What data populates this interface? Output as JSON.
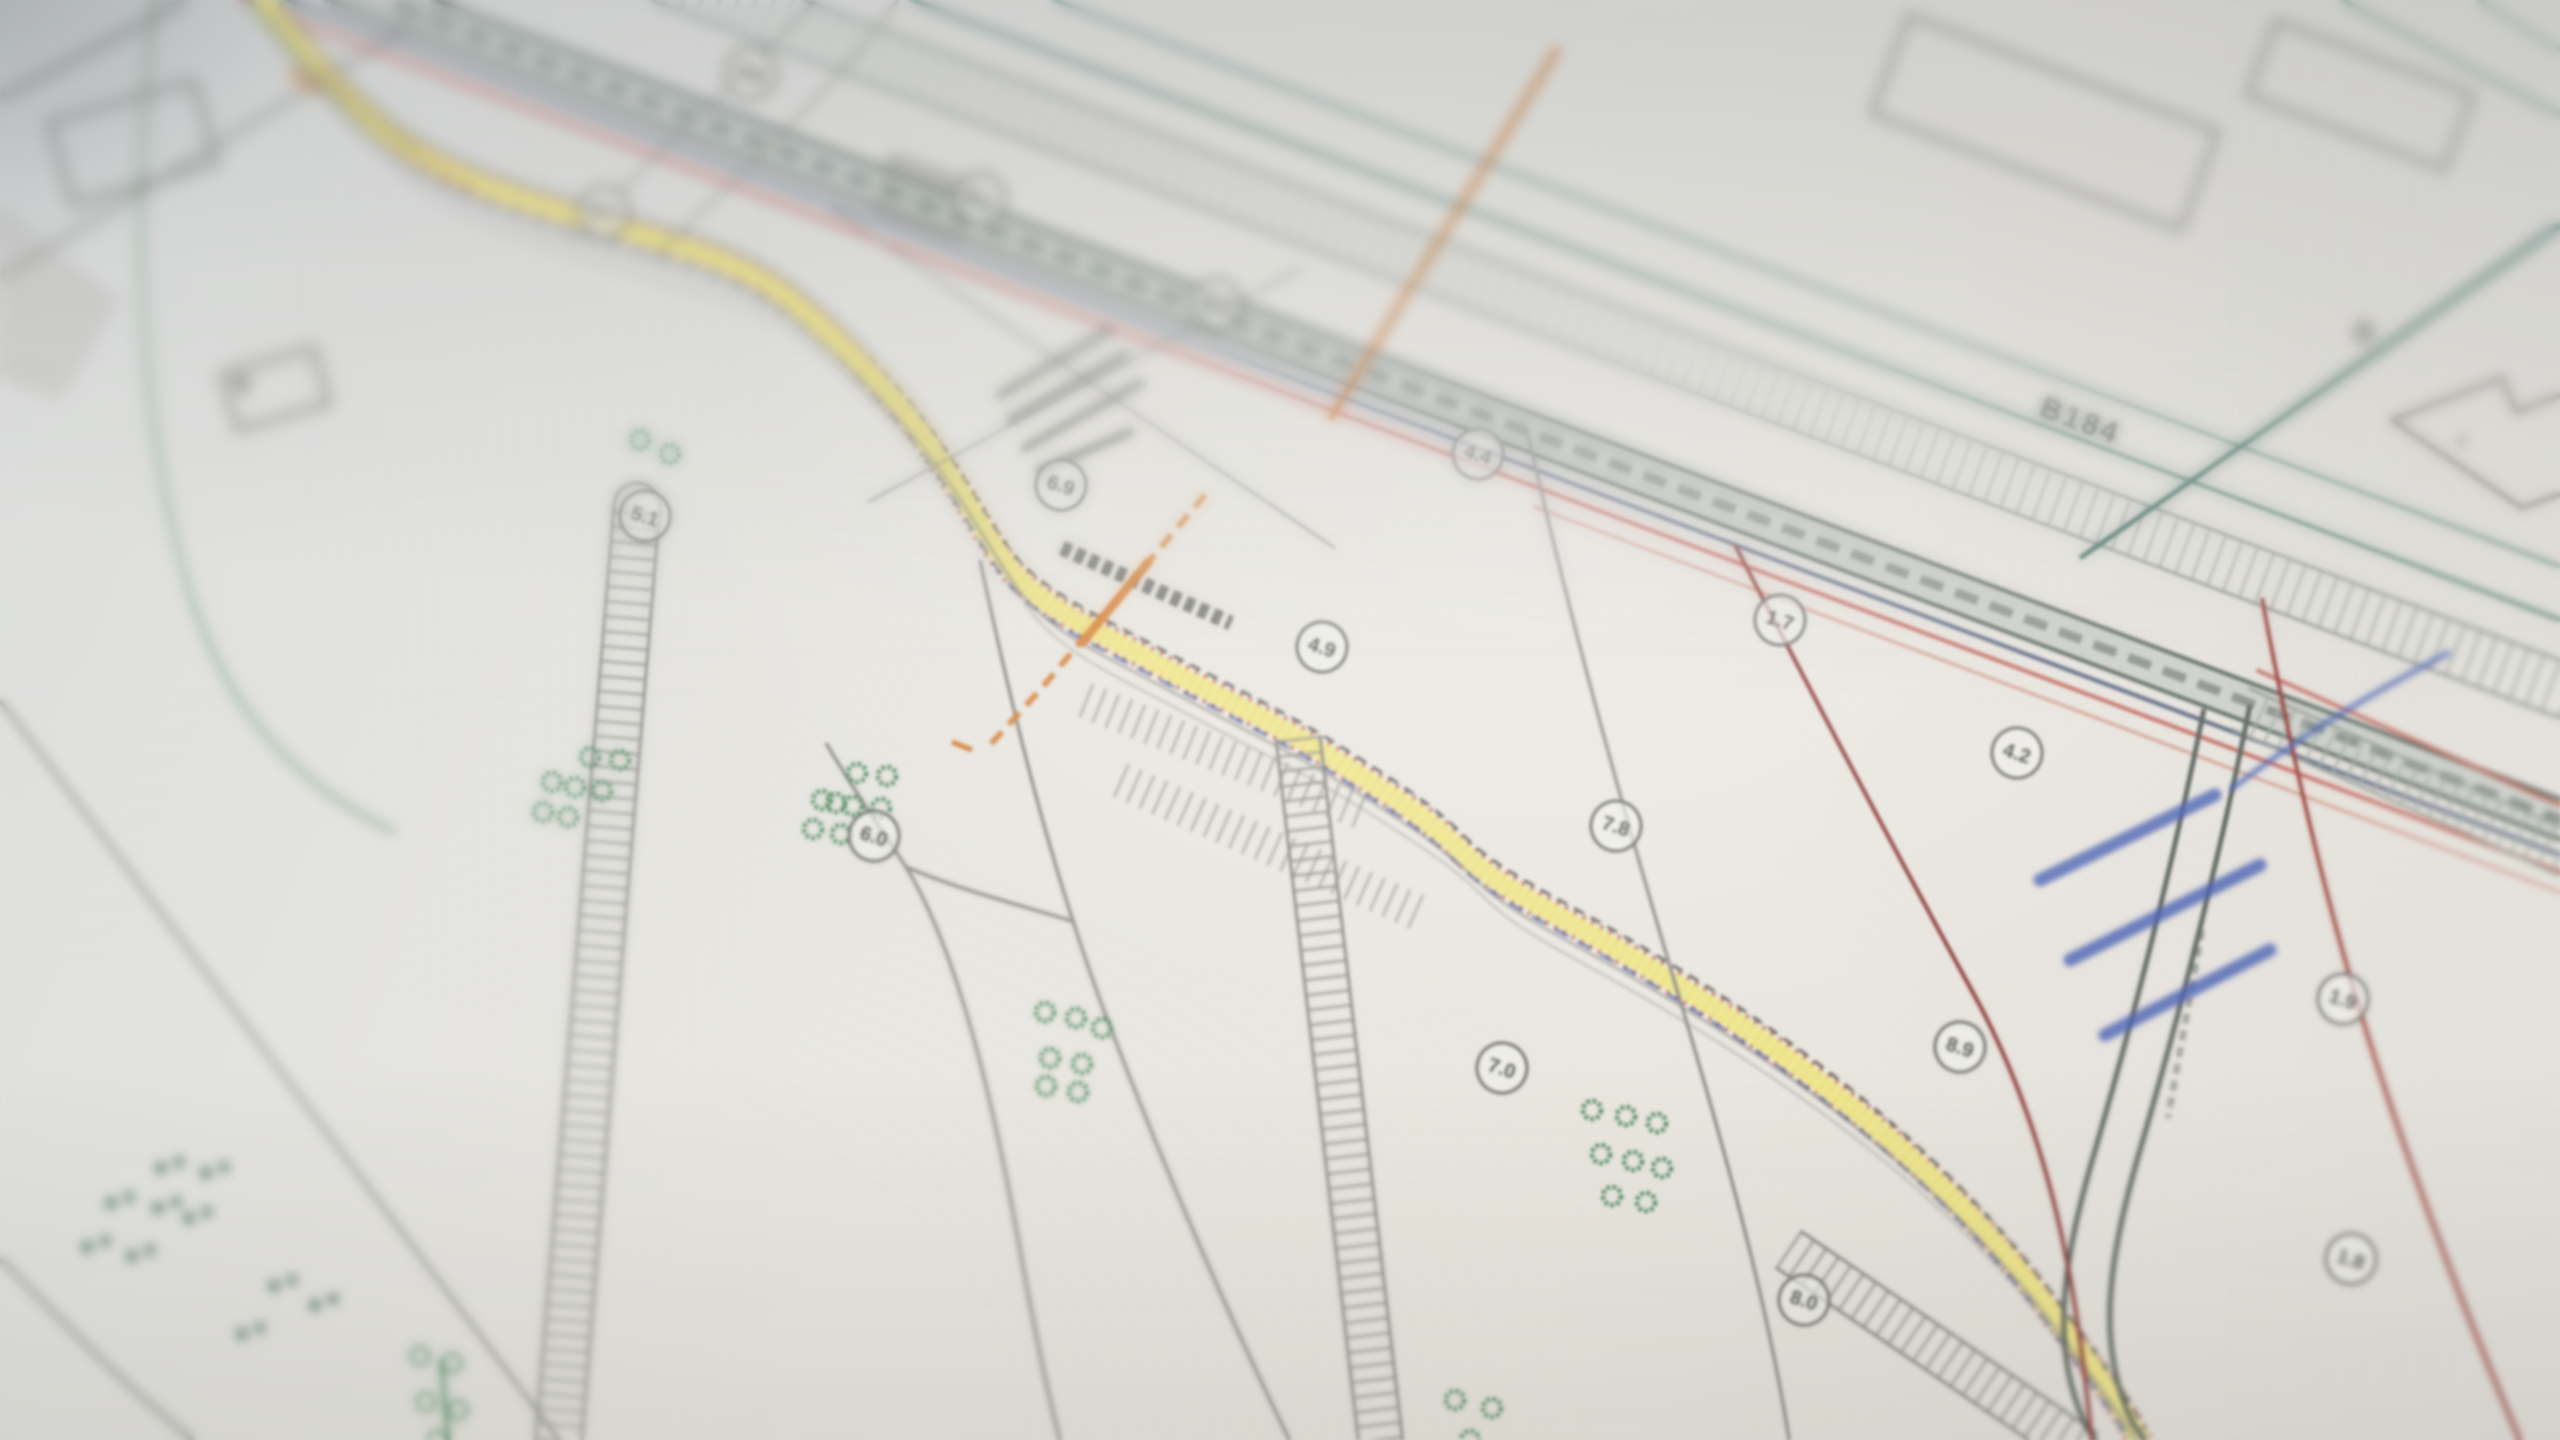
{
  "labels": {
    "road_number": "B184",
    "plot_letter": "D",
    "plot_digit": "4"
  },
  "parcels": [
    {
      "label": "4.6"
    },
    {
      "label": "4.7"
    },
    {
      "label": "4.1"
    },
    {
      "label": "4.3"
    },
    {
      "label": "4.4"
    },
    {
      "label": "6.9"
    },
    {
      "label": "5.1"
    },
    {
      "label": "4.9"
    },
    {
      "label": "1.7"
    },
    {
      "label": "7.8"
    },
    {
      "label": "4.2"
    },
    {
      "label": "6.0"
    },
    {
      "label": "7.0"
    },
    {
      "label": "8.9"
    },
    {
      "label": "1.9"
    },
    {
      "label": "8.0"
    },
    {
      "label": "1.8"
    }
  ],
  "symbols": [
    {
      "name": "tree-rosette-icon",
      "meaning": "tree/bush ring symbol"
    },
    {
      "name": "scrub-dots-icon",
      "meaning": "paired vegetation dots"
    },
    {
      "name": "ladder-hatch-icon",
      "meaning": "hatched track strip"
    },
    {
      "name": "tick-hatch-icon",
      "meaning": "road edge tick hatching"
    }
  ],
  "palette": {
    "paper": "#e8e7e3",
    "road_highlight_yellow": "#efe78a",
    "hatch_red": "#bf5a4e",
    "boundary_teal": "#3f6e64",
    "vegetation_green": "#4e8a5f",
    "annotation_blue": "#4b64b4",
    "survey_orange": "#d8873c",
    "line_gray": "#8f8f8b",
    "road_core_gray": "#5e6a64"
  }
}
